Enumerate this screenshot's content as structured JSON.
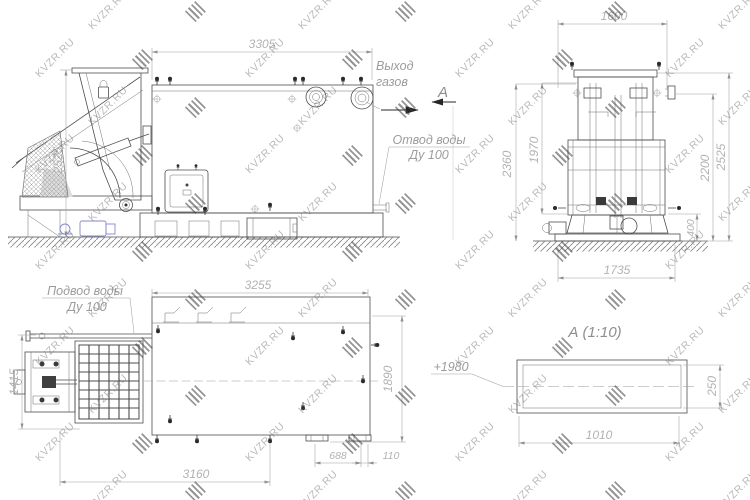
{
  "watermark": {
    "text": "KVZR.RU"
  },
  "side_view": {
    "dim_width": "3305",
    "dim_height": "2525",
    "label_gas_outlet_1": "Выход",
    "label_gas_outlet_2": "газов",
    "section_letter": "А",
    "label_water_outlet_1": "Отвод воды",
    "label_water_outlet_2": "Ду 100"
  },
  "front_view": {
    "dim_width": "1600",
    "dim_height_left_outer": "2360",
    "dim_height_left_inner": "1970",
    "dim_base_height": "400",
    "dim_height_right_inner": "2200",
    "dim_height_right_outer": "2525",
    "dim_base_width": "1735"
  },
  "plan_view": {
    "dim_width": "3255",
    "dim_stoker": "1415",
    "dim_body": "1890",
    "dim_length": "3160",
    "dim_feet": "688",
    "dim_offset": "110",
    "label_water_supply_1": "Подвод воды",
    "label_water_supply_2": "Ду 100"
  },
  "detail_view": {
    "title": "А  (1:10)",
    "elevation": "+1980",
    "dim_width": "1010",
    "dim_height": "250"
  }
}
